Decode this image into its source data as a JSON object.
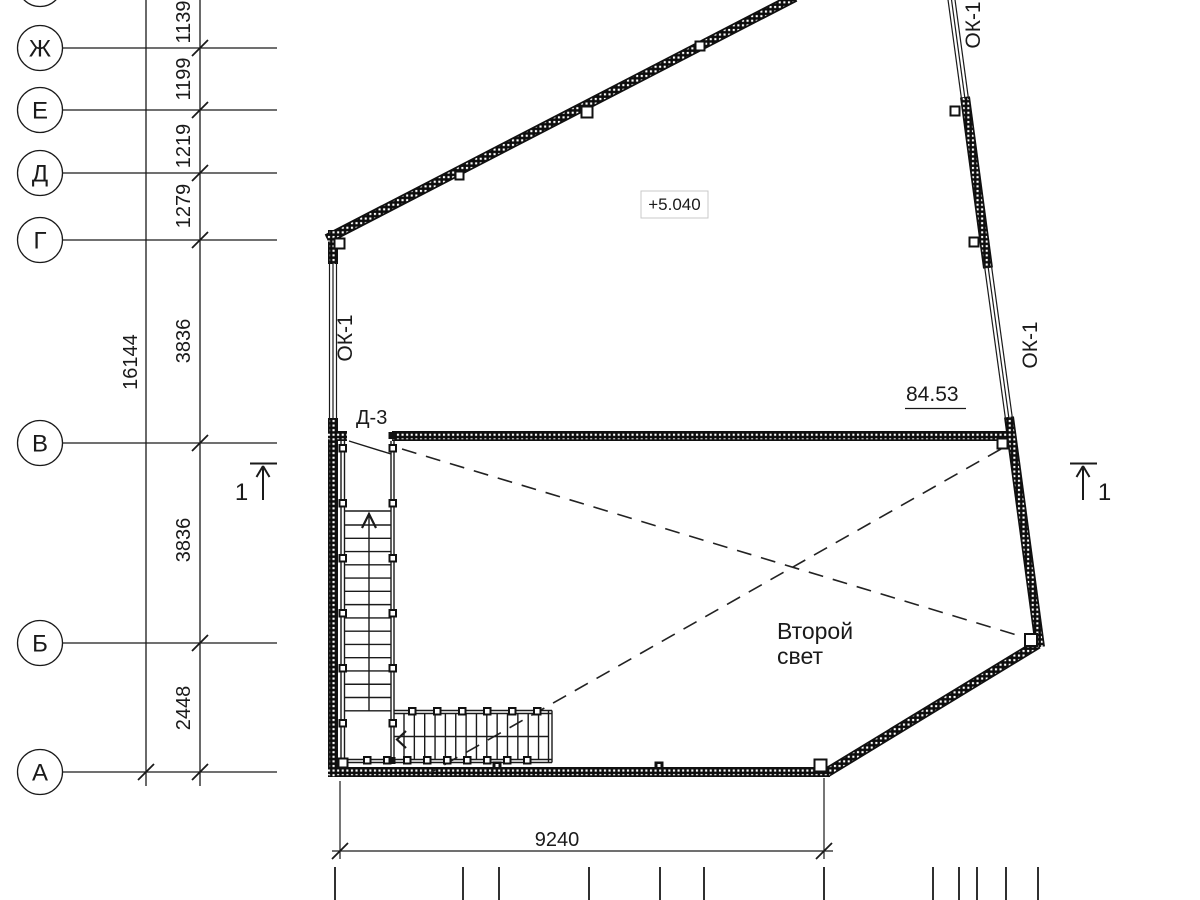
{
  "grid": {
    "row_labels": [
      "Ж",
      "Е",
      "Д",
      "Г",
      "В",
      "Б",
      "А"
    ],
    "spacing_dims": [
      "1139",
      "1199",
      "1219",
      "1279",
      "3836",
      "3836",
      "2448"
    ],
    "total_dim": "16144"
  },
  "dimensions": {
    "bottom_overall": "9240"
  },
  "labels": {
    "elevation_mark": "+5.040",
    "area_mark": "84.53",
    "void_line1": "Второй",
    "void_line2": "свет",
    "door_mark": "Д-3",
    "window_mark": "ОК-1",
    "section_mark": "1"
  },
  "colors": {
    "line": "#1a1a1a",
    "background": "#ffffff",
    "elevation_box_border": "#c9c9c9"
  }
}
